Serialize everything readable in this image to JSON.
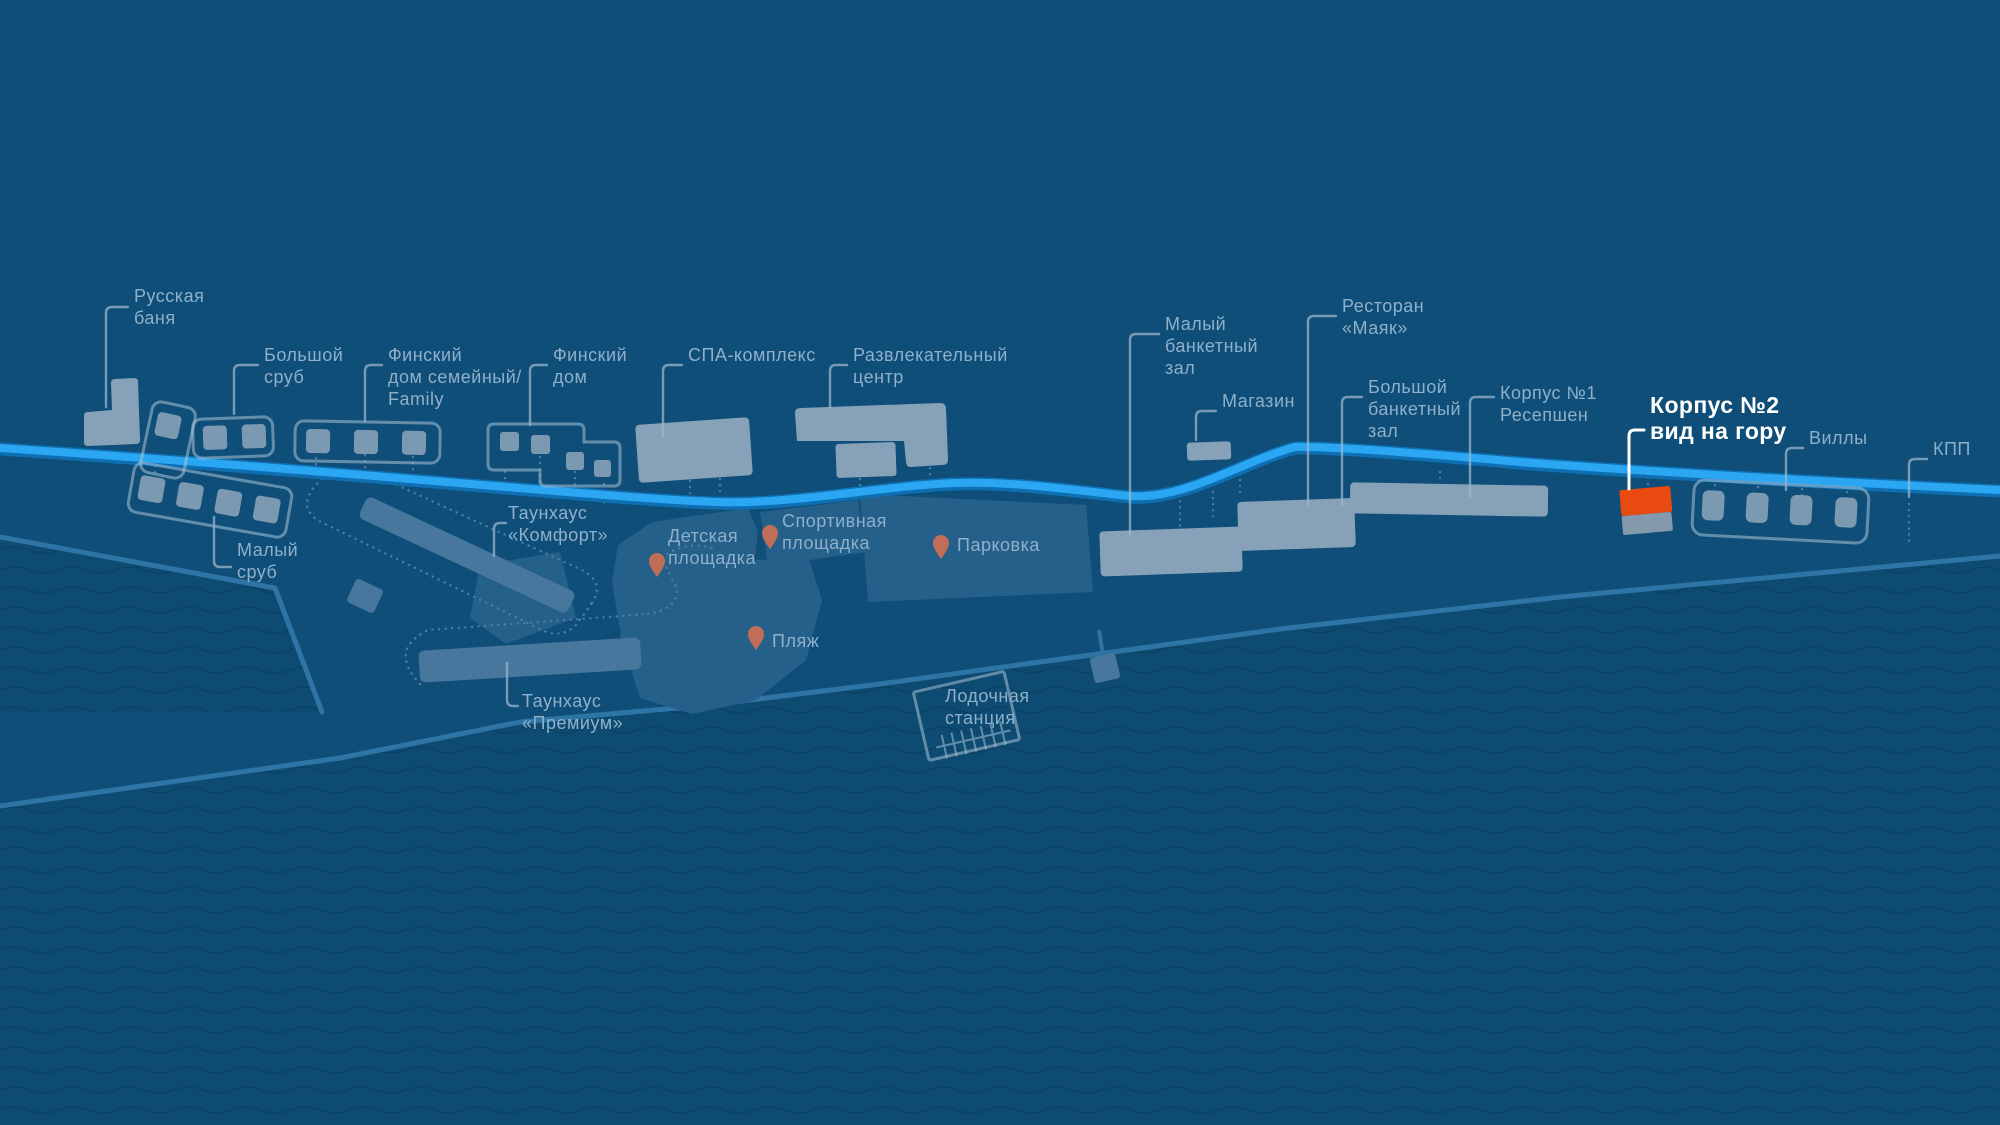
{
  "map": {
    "type": "resort-masterplan",
    "highlighted_poi": "Корпус №2 вид на гору"
  },
  "colors": {
    "background": "#0F4E78",
    "water": "#0E4B72",
    "wave_line": "#0A4062",
    "shoreline": "#2E75A6",
    "road": "#2BA6F2",
    "road_edge": "#0E6FB2",
    "building": "#87A2B8",
    "building_outline": "#A8C2D6",
    "townhouse": "#47779D",
    "region": "#24608A",
    "highlight_orange": "#E84A10",
    "highlight_gray": "#8499AC",
    "pin": "#C06E58",
    "label": "#8FB0C9",
    "highlight_label": "#FFFFFF"
  },
  "labels": {
    "russkaya_banya": {
      "lines": [
        "Русская",
        "баня"
      ]
    },
    "bolshoy_srub": {
      "lines": [
        "Большой",
        "сруб"
      ]
    },
    "finskiy_dom_semeyny": {
      "lines": [
        "Финский",
        "дом семейный/",
        "Family"
      ]
    },
    "finskiy_dom": {
      "lines": [
        "Финский",
        "дом"
      ]
    },
    "spa_complex": {
      "lines": [
        "СПА-комплекс"
      ]
    },
    "razvlekatelny_centr": {
      "lines": [
        "Развлекательный",
        "центр"
      ]
    },
    "maly_banketny_zal": {
      "lines": [
        "Малый",
        "банкетный",
        "зал"
      ]
    },
    "restoran_mayak": {
      "lines": [
        "Ресторан",
        "«Маяк»"
      ]
    },
    "magazin": {
      "lines": [
        "Магазин"
      ]
    },
    "bolshoy_banketny_zal": {
      "lines": [
        "Большой",
        "банкетный",
        "зал"
      ]
    },
    "korpus1_resepshen": {
      "lines": [
        "Корпус №1",
        "Ресепшен"
      ]
    },
    "korpus2": {
      "lines": [
        "Корпус №2",
        "вид на гору"
      ]
    },
    "villy": {
      "lines": [
        "Виллы"
      ]
    },
    "kpp": {
      "lines": [
        "КПП"
      ]
    },
    "maly_srub": {
      "lines": [
        "Малый",
        "сруб"
      ]
    },
    "taunhaus_komfort": {
      "lines": [
        "Таунхаус",
        "«Комфорт»"
      ]
    },
    "detskaya_ploshchadka": {
      "lines": [
        "Детская",
        "площадка"
      ]
    },
    "sportivnaya_ploshchadka": {
      "lines": [
        "Спортивная",
        "площадка"
      ]
    },
    "parkovka": {
      "lines": [
        "Парковка"
      ]
    },
    "plyazh": {
      "lines": [
        "Пляж"
      ]
    },
    "taunhaus_premium": {
      "lines": [
        "Таунхаус",
        "«Премиум»"
      ]
    },
    "lodochnaya_stantsiya": {
      "lines": [
        "Лодочная",
        "станция"
      ]
    }
  }
}
